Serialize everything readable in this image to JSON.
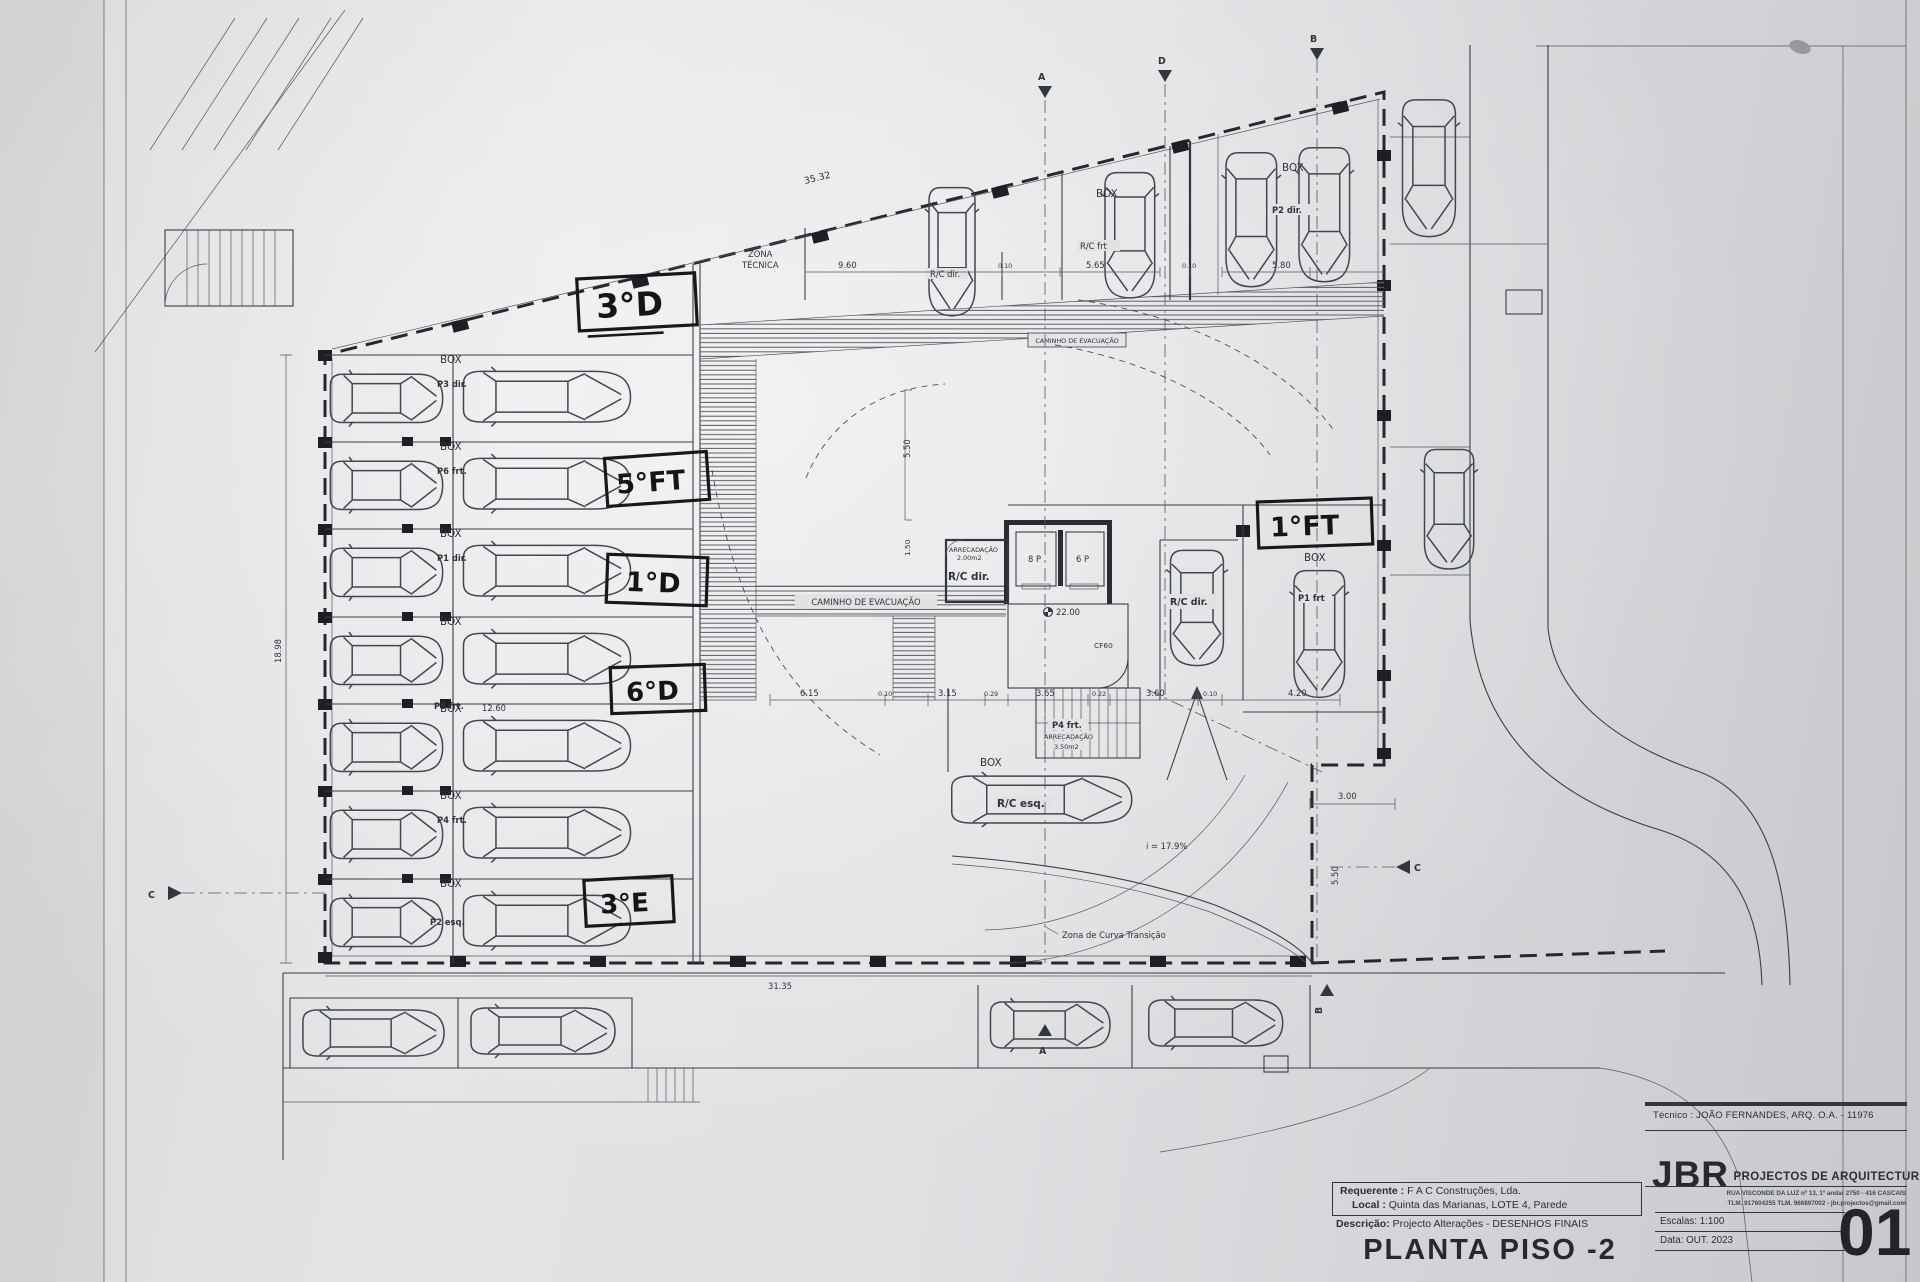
{
  "titleblock": {
    "tecnico": "Técnico : JOÃO FERNANDES, ARQ.   O.A. - 11976",
    "requerente_label": "Requerente :",
    "requerente_value": "F A C  Construções, Lda.",
    "local_label": "Local :",
    "local_value": "Quinta das Marianas, LOTE 4, Parede",
    "descricao_label": "Descrição:",
    "descricao_value": "Projecto Alterações - DESENHOS FINAIS",
    "drawing_title": "PLANTA PISO -2",
    "firm_logo": "JBR",
    "firm_name": "PROJECTOS DE ARQUITECTURA",
    "firm_address": "RUA VISCONDE DA LUZ nº 13, 1º andar  2750 - 416  CASCAIS",
    "firm_contacts": "TLM. 917604255  TLM. 966897002 - jbr.projectos@gmail.com",
    "escalas_label": "Escalas:",
    "escalas_value": "1:100",
    "data_label": "Data:",
    "data_value": "OUT. 2023",
    "sheet_number": "01"
  },
  "handwritten": {
    "a1": "3°D",
    "a2": "5°FT",
    "a3": "1°D",
    "a4": "6°D",
    "a5": "3°E",
    "a6": "1°FT"
  },
  "rows": [
    {
      "box": "BOX",
      "stall": "P3 dir."
    },
    {
      "box": "BOX",
      "stall": "P6 frt."
    },
    {
      "box": "BOX",
      "stall": "P1 dir."
    },
    {
      "box": "BOX",
      "stall": "P5 frt."
    },
    {
      "box": "BOX",
      "stall": ""
    },
    {
      "box": "BOX",
      "stall": "P4 frt."
    },
    {
      "box": "BOX",
      "stall": "P2 esq."
    }
  ],
  "labels": {
    "zona_tecnica_1": "ZONA",
    "zona_tecnica_2": "TÉCNICA",
    "caminho_evacuacao": "CAMINHO DE EVACUAÇÃO",
    "curva_transicao": "Zona de Curva Transição",
    "rc_dir": "R/C dir.",
    "rc_esq": "R/C esq.",
    "rc_frt": "R/C frt",
    "box": "BOX",
    "p2_dir": "P2 dir.",
    "p1_frt": "P1 frt",
    "p4_frt": "P4 frt.",
    "arrecadacao": "ARRECADAÇÃO",
    "arrec_area_1": "2.00m2",
    "arrec_area_2": "3.50m2",
    "lift_left": "8 P",
    "lift_right": "6 P",
    "level_mark": "22.00",
    "door": "CF60",
    "slope": "i = 17.9%"
  },
  "dims": {
    "top_slant": "35.32",
    "top_a": "9.60",
    "d010": "0.10",
    "rcfrt": "5.65",
    "p2": "5.80",
    "left_width": "12.60",
    "left_height": "18.98",
    "mid": [
      "6.15",
      "0.10",
      "3.15",
      "0.29",
      "3.65",
      "0.22",
      "3.60",
      "0.10",
      "4.20"
    ],
    "right_a": "3.00",
    "right_b": "5.50",
    "core_a": "1.50",
    "top_b": "5.50",
    "bottom": "31.35"
  },
  "sections": {
    "a": "A",
    "b": "B",
    "c": "C",
    "d": "D"
  }
}
